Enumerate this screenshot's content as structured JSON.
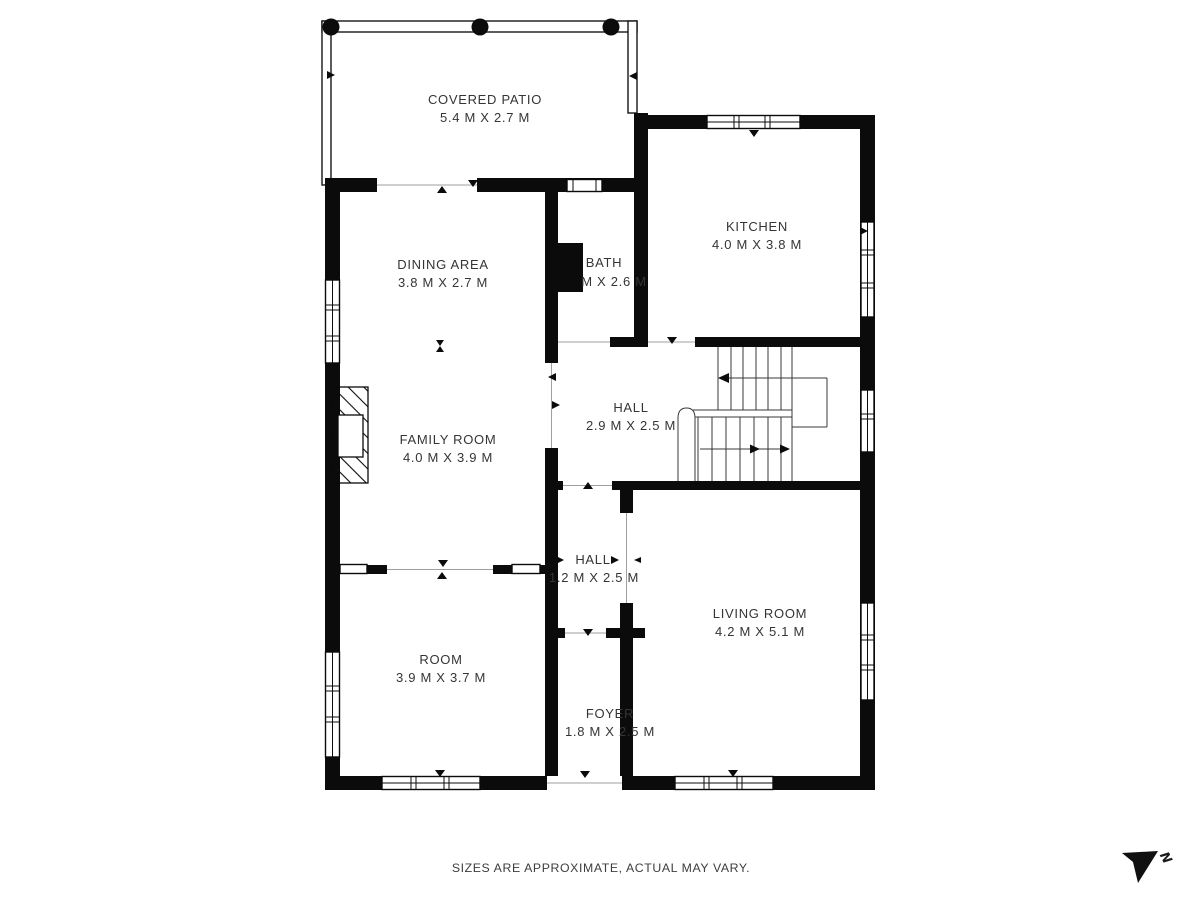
{
  "meta": {
    "footer": "SIZES ARE APPROXIMATE, ACTUAL MAY VARY.",
    "compass_label": "N"
  },
  "colors": {
    "wall": "#0b0b0b",
    "text": "#353535",
    "opening_line": "#9f9f9f",
    "background": "#ffffff"
  },
  "rooms": [
    {
      "name": "COVERED PATIO",
      "dims": "5.4 M X 2.7 M"
    },
    {
      "name": "KITCHEN",
      "dims": "4.0 M X 3.8 M"
    },
    {
      "name": "DINING AREA",
      "dims": "3.8 M X 2.7 M"
    },
    {
      "name": "BATH",
      "dims": "M X 2.6 M"
    },
    {
      "name": "HALL",
      "dims": "2.9 M X 2.5 M"
    },
    {
      "name": "FAMILY ROOM",
      "dims": "4.0 M X 3.9 M"
    },
    {
      "name": "HALL",
      "dims": "1.2 M X 2.5 M"
    },
    {
      "name": "LIVING ROOM",
      "dims": "4.2 M X 5.1 M"
    },
    {
      "name": "ROOM",
      "dims": "3.9 M X 3.7 M"
    },
    {
      "name": "FOYER",
      "dims": "1.8 M X 2.5 M"
    }
  ]
}
